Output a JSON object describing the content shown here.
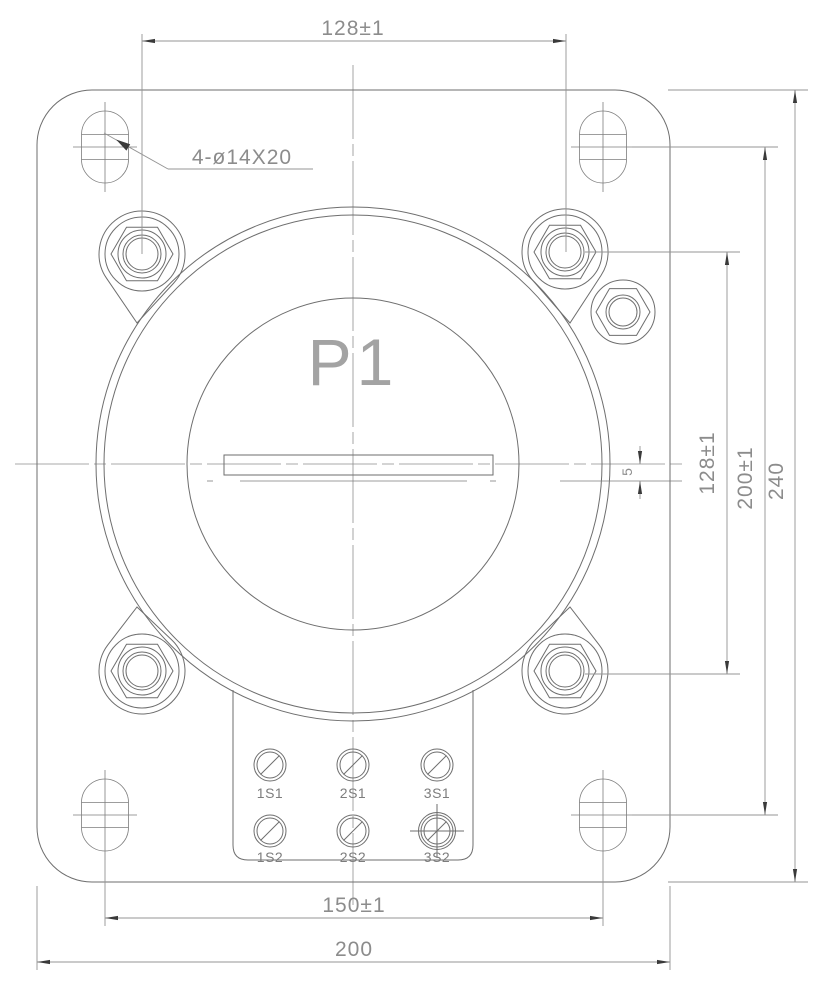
{
  "drawing": {
    "marking": "P1",
    "callout": "4-ø14X20",
    "dimensions": {
      "top_width": "128±1",
      "right_bolt_spacing": "128±1",
      "right_slot_spacing": "200±1",
      "right_overall_height": "240",
      "bottom_slot_spacing": "150±1",
      "bottom_overall_width": "200",
      "bar_gap": "5"
    },
    "terminals": [
      "1S1",
      "2S1",
      "3S1",
      "1S2",
      "2S2",
      "3S2"
    ],
    "colors": {
      "line": "#6e6e6e",
      "dimension": "#949494",
      "text": "#8c8c8c",
      "arrow": "#3a3a3a",
      "background": "#ffffff"
    }
  }
}
